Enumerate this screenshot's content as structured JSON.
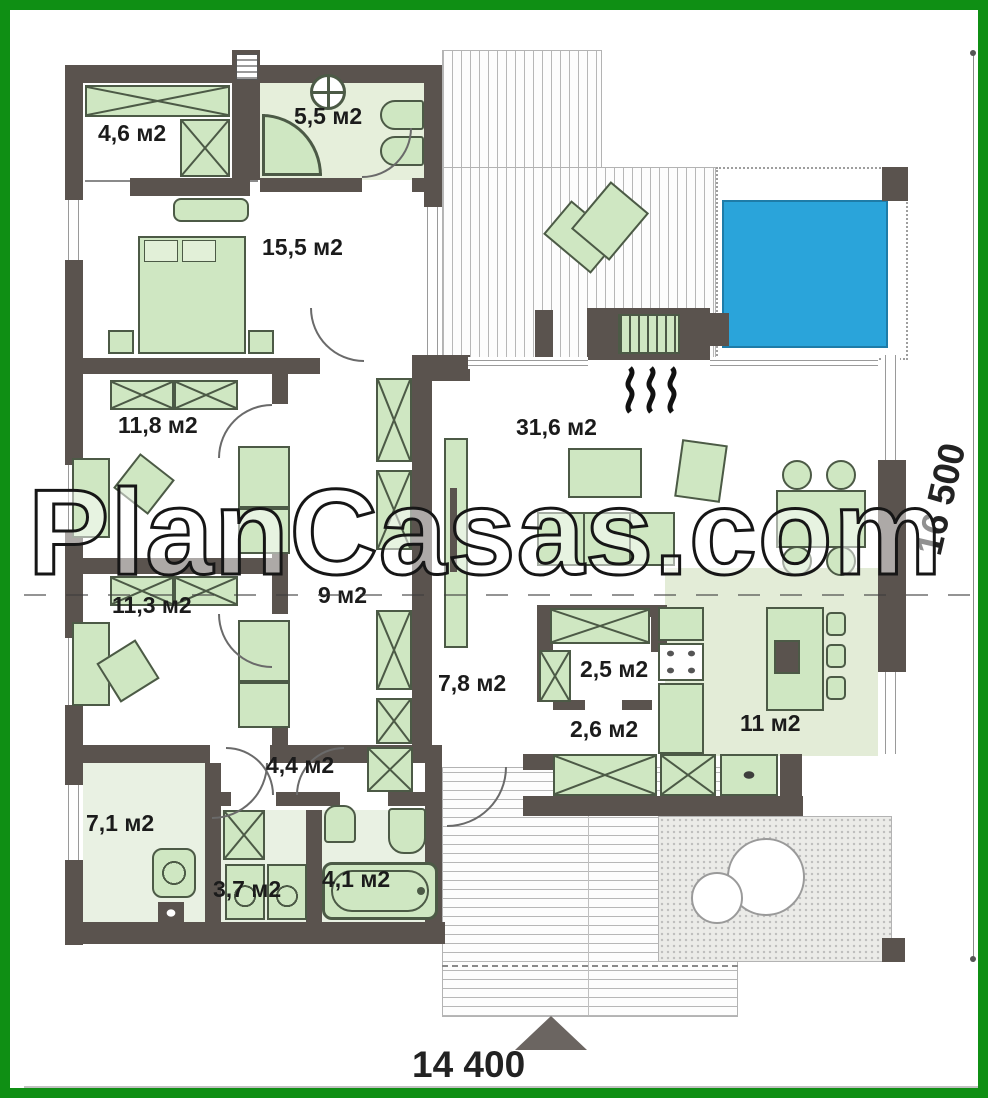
{
  "watermark": {
    "text": "PlanCasas.com"
  },
  "dimensions": {
    "width_label": "14 400",
    "height_label": "16 500"
  },
  "rooms": [
    {
      "name": "wardrobe",
      "area_label": "4,6 м2"
    },
    {
      "name": "bathroom-top",
      "area_label": "5,5 м2"
    },
    {
      "name": "bedroom-master",
      "area_label": "15,5 м2"
    },
    {
      "name": "bedroom-2",
      "area_label": "11,8 м2"
    },
    {
      "name": "living-room",
      "area_label": "31,6 м2"
    },
    {
      "name": "bedroom-3",
      "area_label": "11,3 м2"
    },
    {
      "name": "hall",
      "area_label": "9 м2"
    },
    {
      "name": "hallway",
      "area_label": "7,8 м2"
    },
    {
      "name": "pantry",
      "area_label": "2,5 м2"
    },
    {
      "name": "vestibule",
      "area_label": "2,6 м2"
    },
    {
      "name": "kitchen",
      "area_label": "11 м2"
    },
    {
      "name": "utility",
      "area_label": "7,1 м2"
    },
    {
      "name": "entry-hall",
      "area_label": "4,4 м2"
    },
    {
      "name": "laundry",
      "area_label": "3,7 м2"
    },
    {
      "name": "bathroom-bottom",
      "area_label": "4,1 м2"
    }
  ],
  "colors": {
    "frame_green": "#0f8f14",
    "wall_gray": "#5a534e",
    "furniture_green": "#cfe7c2",
    "pool_blue": "#2aa4da",
    "bath_tint": "#e6efdb",
    "kitchen_tint": "#e3ecd7"
  }
}
